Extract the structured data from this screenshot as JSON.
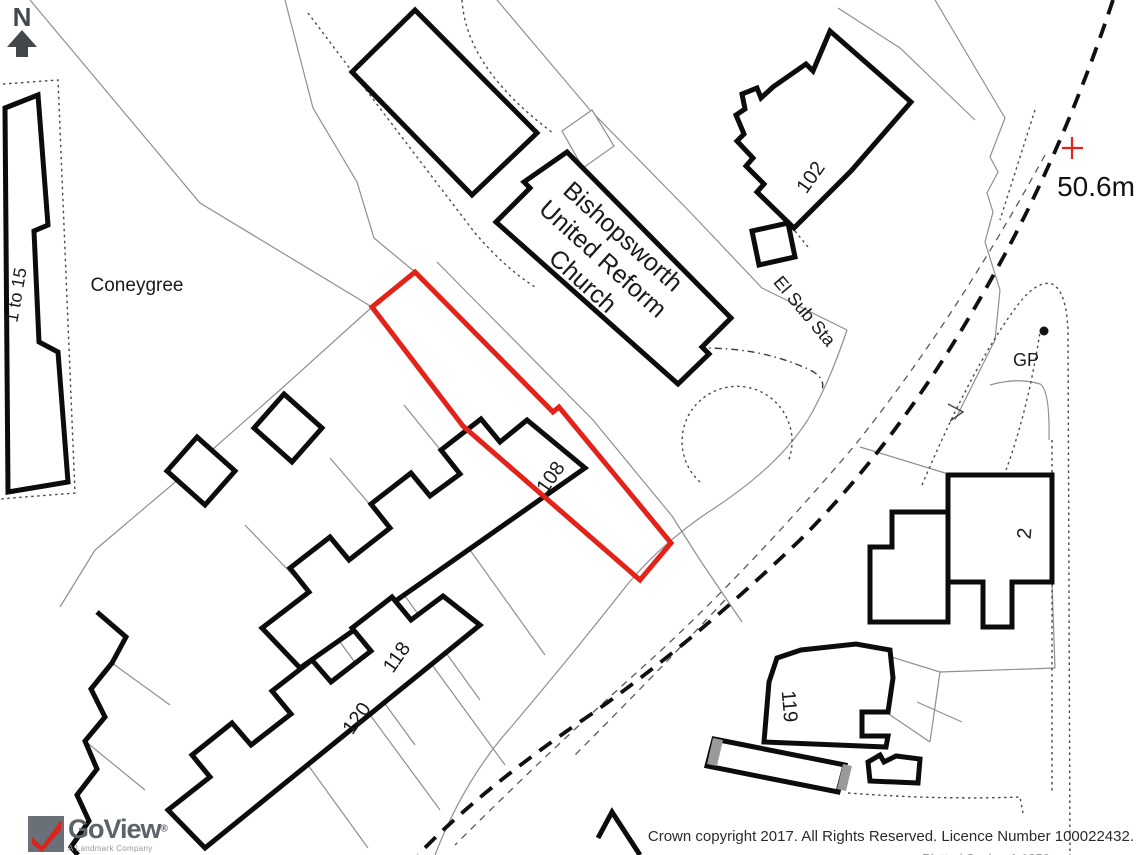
{
  "map": {
    "labels": {
      "north": "N",
      "one_to_15": "1 to 15",
      "coneygree": "Coneygree",
      "church_line1": "Bishopsworth",
      "church_line2": "United Reform",
      "church_line3": "Church",
      "el_sub_sta": "El Sub Sta",
      "no_102": "102",
      "no_108": "108",
      "no_118": "118",
      "no_120": "120",
      "no_119": "119",
      "no_2": "2",
      "gp": "GP",
      "spot_height": "50.6m"
    },
    "colors": {
      "plot_outline": "#e32219",
      "building_outline": "#0c0c0c",
      "thin_line": "#8f8f8f",
      "north_arrow": "#43484d",
      "spot_cross": "#e32219"
    }
  },
  "branding": {
    "logo_text": "GoView",
    "logo_reg": "®",
    "logo_sub": "A Landmark Company"
  },
  "footer": {
    "copyright": "Crown copyright 2017. All Rights Reserved. Licence Number 100022432.",
    "clipped_line": "Plotted Scale - 1:1250"
  }
}
